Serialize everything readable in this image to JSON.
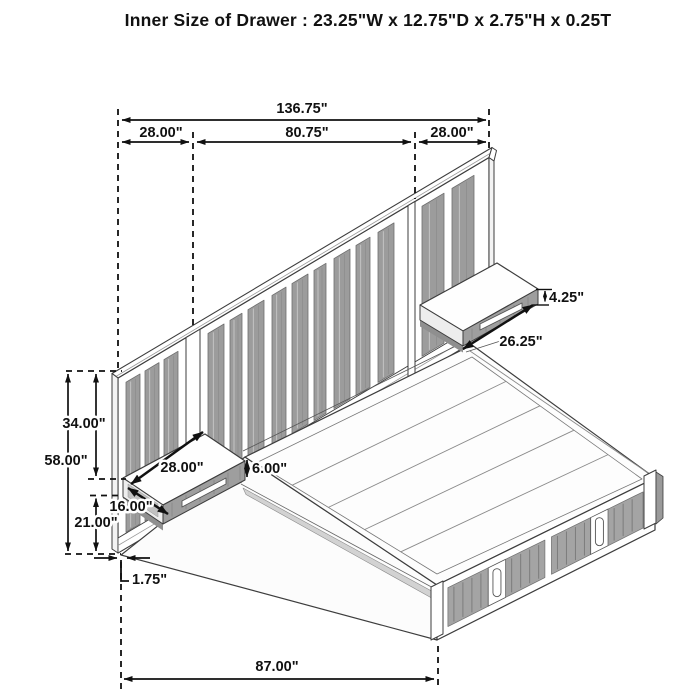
{
  "title": "Inner Size of Drawer : 23.25\"W x 12.75\"D x 2.75\"H x 0.25T",
  "dims": {
    "overall": "136.75\"",
    "left_wing": "28.00\"",
    "center": "80.75\"",
    "right_wing": "28.00\"",
    "ns_right_height": "4.25\"",
    "ns_right_width": "26.25\"",
    "upper_height": "34.00\"",
    "total_height": "58.00\"",
    "ns_left_width": "28.00\"",
    "ns_left_height": "6.00\"",
    "ns_left_depth": "16.00\"",
    "lower_height": "21.00\"",
    "base_thickness": "1.75\"",
    "bed_length": "87.00\""
  },
  "colors": {
    "background": "#ffffff",
    "line": "#3d3d3d",
    "dim": "#111111",
    "text": "#111111",
    "slat": "#9c9c9c",
    "slat_edge": "#6e6e6e",
    "slat_grain": "#c8c8c8",
    "panel": "#ffffff",
    "deck": "#fdfdfd",
    "drawer_gray": "#a4a4a4",
    "drawer_stripe": "#7c7c7c",
    "shadow": "#8f8f8f",
    "band": "#d2d2d2"
  }
}
